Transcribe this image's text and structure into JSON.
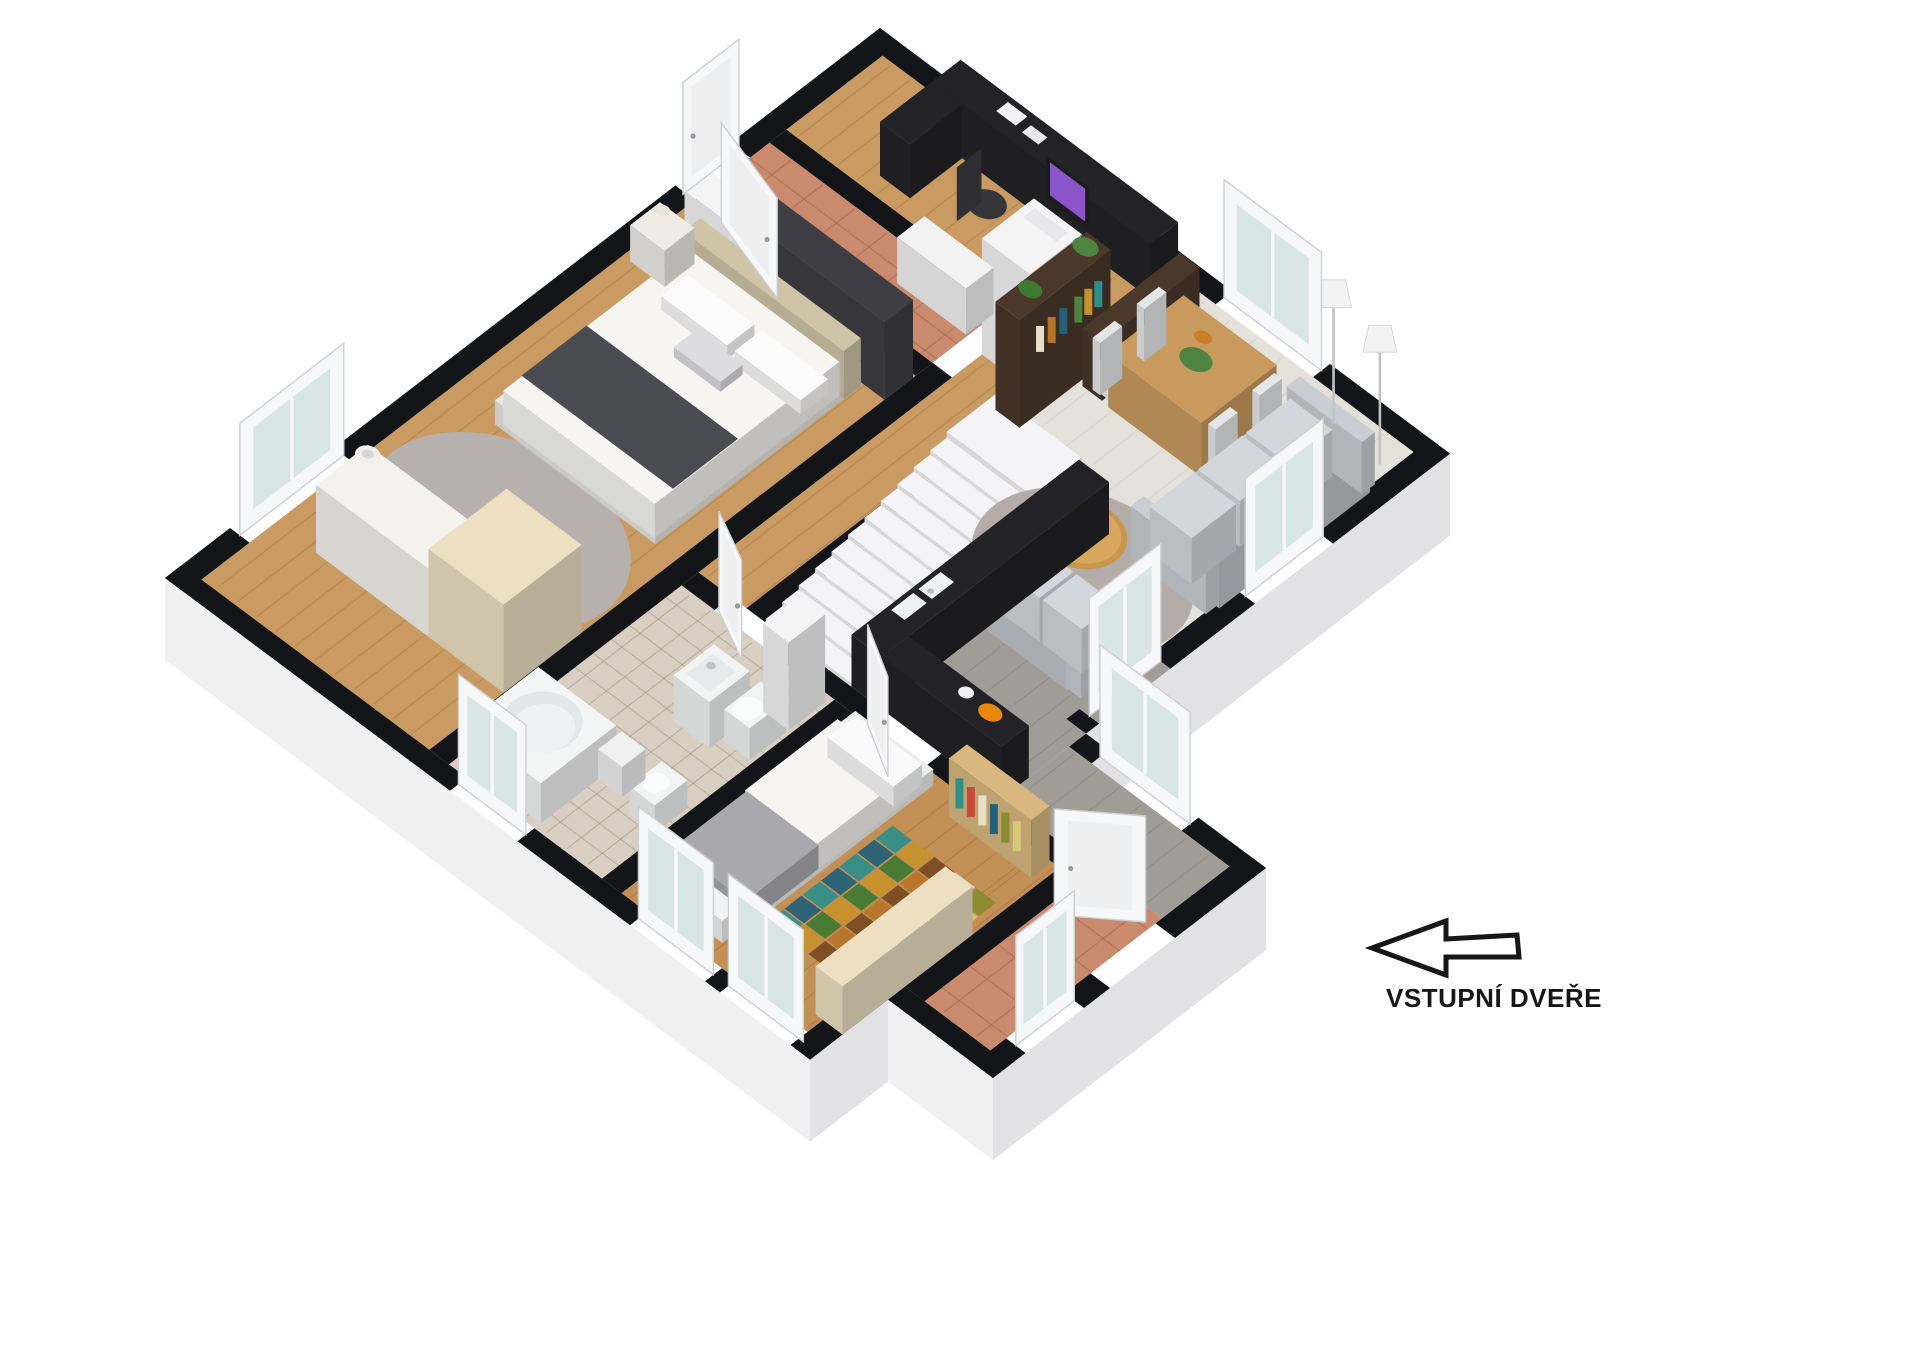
{
  "annotation": {
    "entrance_label": "VSTUPNÍ DVEŘE",
    "arrow_direction": "left",
    "arrow_style": "black-outline-white-fill"
  },
  "palette": {
    "wall_cap": "#141518",
    "wall_face_light": "#f0f0f1",
    "wall_face_dark": "#e2e2e5",
    "wood": "#c99a62",
    "wood2": "#c28f55",
    "terracotta": "#c98a6d",
    "tile": "#d8cfc2",
    "living_floor": "#e3e1da",
    "kitchen_floor": "#a09c96",
    "counter_dark": "#232327",
    "stair_white": "#f4f4f6",
    "rug_gray": "#b7b1ae",
    "living_rug": "#b3aca9",
    "sofa_gray": "#c6cacf",
    "cream": "#ecdfc2",
    "soft_white": "#f6f5f2",
    "dark_wood": "#4a382a",
    "wardrobe_dark": "#3e3e44",
    "bed_band_dark": "#4b4b52",
    "headboard_beige": "#cfc3a8",
    "glass": "#d9e4e4",
    "plant_green": "#4e8440",
    "monitor_purple": "#8a55c8",
    "fruit_orange": "#e8890a",
    "patch_colors": [
      "#2e8f8a",
      "#c8922a",
      "#7a4a22",
      "#e8dfc8",
      "#8a8a30",
      "#23607a",
      "#3f7a33",
      "#b8742a",
      "#1f6f6e",
      "#d8c87a"
    ]
  },
  "rooms": [
    {
      "id": "master-bedroom",
      "name": "Master bedroom",
      "floor": "wood"
    },
    {
      "id": "hallway-top",
      "name": "Upper hallway",
      "floor": "terracotta"
    },
    {
      "id": "office-nook",
      "name": "Office nook",
      "floor": "wood"
    },
    {
      "id": "living-dining",
      "name": "Living and dining room",
      "floor": "pale-plank"
    },
    {
      "id": "kitchen",
      "name": "Kitchen",
      "floor": "gray-plank"
    },
    {
      "id": "center-hall",
      "name": "Central hall",
      "floor": "wood"
    },
    {
      "id": "staircase",
      "name": "Staircase",
      "floor": "white"
    },
    {
      "id": "bathroom",
      "name": "Bathroom",
      "floor": "beige-tile"
    },
    {
      "id": "bedroom-2",
      "name": "Bedroom",
      "floor": "wood"
    },
    {
      "id": "entrance-hall",
      "name": "Entrance hall",
      "floor": "terracotta"
    }
  ],
  "furniture": [
    {
      "id": "double-bed",
      "room": "master-bedroom",
      "label": "Double bed"
    },
    {
      "id": "wardrobe-dark",
      "room": "master-bedroom",
      "label": "Dark wardrobe"
    },
    {
      "id": "nightstand",
      "room": "master-bedroom",
      "label": "Nightstand"
    },
    {
      "id": "dresser",
      "room": "master-bedroom",
      "label": "Dresser"
    },
    {
      "id": "round-rug",
      "room": "master-bedroom",
      "label": "Round gray rug"
    },
    {
      "id": "vase",
      "room": "master-bedroom",
      "label": "Floor vase"
    },
    {
      "id": "office-desk",
      "room": "office-nook",
      "label": "Desk"
    },
    {
      "id": "computer-monitor",
      "room": "office-nook",
      "label": "Computer monitor"
    },
    {
      "id": "office-chair",
      "room": "office-nook",
      "label": "Office chair"
    },
    {
      "id": "storage-cabinet",
      "room": "office-nook",
      "label": "Storage cabinet"
    },
    {
      "id": "display-bookshelf",
      "room": "living-dining",
      "label": "Bookshelf with plants"
    },
    {
      "id": "shoe-cabinet",
      "room": "hallway-top",
      "label": "Shoe cabinet"
    },
    {
      "id": "dining-table",
      "room": "living-dining",
      "label": "Dining table"
    },
    {
      "id": "dining-chairs",
      "room": "living-dining",
      "label": "Dining chairs"
    },
    {
      "id": "sideboard",
      "room": "living-dining",
      "label": "Sideboard"
    },
    {
      "id": "floor-lamp",
      "room": "living-dining",
      "label": "Floor lamp"
    },
    {
      "id": "floor-lamp-2",
      "room": "living-dining",
      "label": "Corner floor lamp"
    },
    {
      "id": "sofa-three-seat",
      "room": "living-dining",
      "label": "Three-seat sofa"
    },
    {
      "id": "sofa-two-seat",
      "room": "living-dining",
      "label": "Two-seat sofa"
    },
    {
      "id": "coffee-table",
      "room": "living-dining",
      "label": "Round coffee table"
    },
    {
      "id": "living-rug",
      "room": "living-dining",
      "label": "Round area rug"
    },
    {
      "id": "staircase-steps",
      "room": "staircase",
      "label": "Stairs"
    },
    {
      "id": "kitchen-counter",
      "room": "kitchen",
      "label": "Kitchen counter"
    },
    {
      "id": "kitchen-sink",
      "room": "kitchen",
      "label": "Double sink"
    },
    {
      "id": "fruit-bowl",
      "room": "kitchen",
      "label": "Fruit bowl"
    },
    {
      "id": "bathtub",
      "room": "bathroom",
      "label": "Corner bathtub"
    },
    {
      "id": "washbasin",
      "room": "bathroom",
      "label": "Washbasin vanity"
    },
    {
      "id": "toilet",
      "room": "bathroom",
      "label": "Toilet"
    },
    {
      "id": "bidet",
      "room": "bathroom",
      "label": "Bidet"
    },
    {
      "id": "bathroom-cabinet",
      "room": "bathroom",
      "label": "Tall cabinet"
    },
    {
      "id": "single-bed",
      "room": "bedroom-2",
      "label": "Single bed"
    },
    {
      "id": "patchwork-rug",
      "room": "bedroom-2",
      "label": "Patchwork rug"
    },
    {
      "id": "wall-bookshelf",
      "room": "bedroom-2",
      "label": "Book rack"
    },
    {
      "id": "desk-shelf",
      "room": "bedroom-2",
      "label": "Desk shelf"
    },
    {
      "id": "coat-rack",
      "room": "entrance-hall",
      "label": "Coat rack"
    }
  ]
}
